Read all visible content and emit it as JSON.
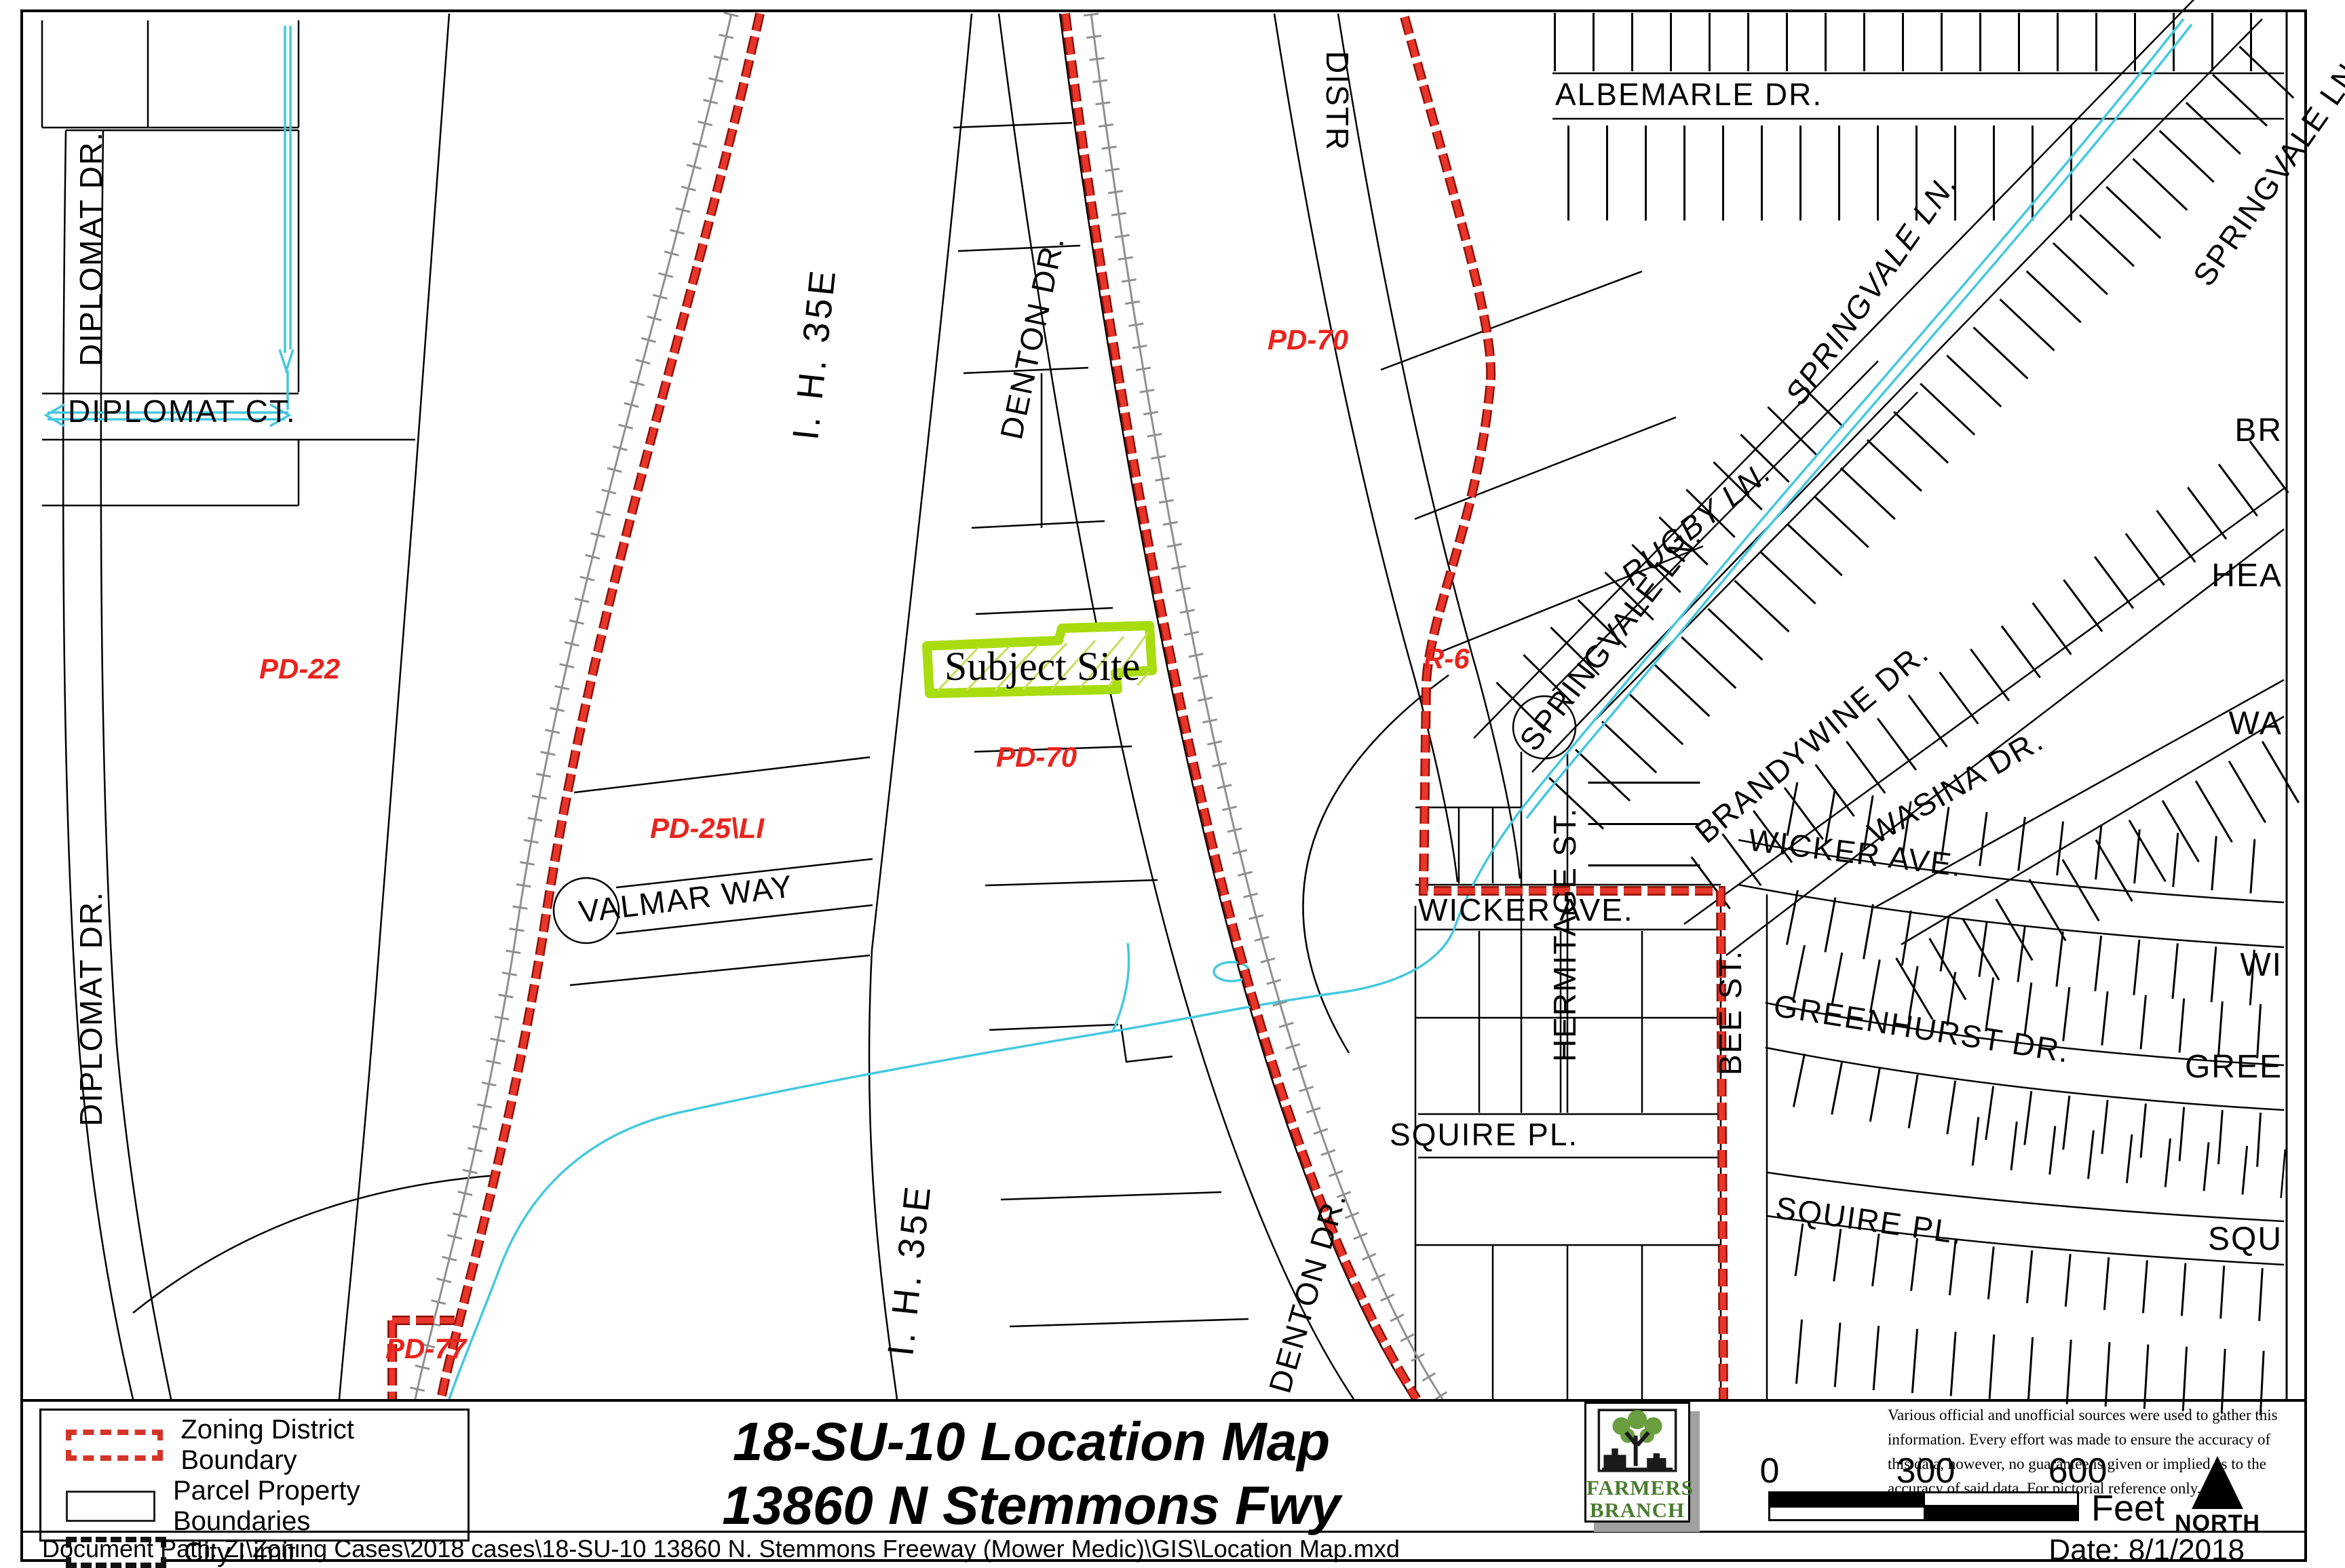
{
  "map": {
    "street_labels": {
      "diplomat_dr_top": "DIPLOMAT DR.",
      "diplomat_dr_bottom": "DIPLOMAT DR.",
      "diplomat_ct": "DIPLOMAT CT.",
      "ih35e_top": "I. H. 35E",
      "ih35e_bottom": "I. H. 35E",
      "denton_dr": "DENTON DR.",
      "denton_dr_lower": "DENTON DR.",
      "distr": "DISTR",
      "valmar_way": "VALMAR WAY",
      "albemarle_dr": "ALBEMARLE DR.",
      "rugby_ln": "RUGBY LN.",
      "springvale_ln_upper": "SPRINGVALE LN.",
      "springvale_ln_lower": "SPRINGVALE LN.",
      "springvale_ln_corner": "SPRINGVALE LN.",
      "brandywine_dr": "BRANDYWINE DR.",
      "wasina_dr": "WASINA DR.",
      "wicker_ave_right": "WICKER AVE.",
      "wicker_ave_left": "WICKER AVE.",
      "hermitage_st": "HERMITAGE ST.",
      "greenhurst_dr": "GREENHURST DR.",
      "bee_st": "BEE ST.",
      "squire_pl_left": "SQUIRE PL.",
      "squire_pl_right": "SQUIRE PL."
    },
    "edge_labels": {
      "br": "BR",
      "hea": "HEA",
      "wa": "WA",
      "wi": "WI",
      "gree": "GREE",
      "squ": "SQU"
    },
    "zoning_labels": {
      "pd22": "PD-22",
      "pd70_top": "PD-70",
      "pd70_mid": "PD-70",
      "pd25li": "PD-25\\LI",
      "r6": "R-6",
      "pd77": "PD-77"
    },
    "subject_site_label": "Subject Site",
    "colors": {
      "zoning_boundary_red": "#d43427",
      "subject_site_green": "#a8dc0e",
      "creek_cyan": "#45c8e0",
      "railroad_gray": "#909090"
    }
  },
  "legend": {
    "items": [
      {
        "label": "Zoning District Boundary",
        "swatch": "red-dashed-rectangle"
      },
      {
        "label": "Parcel Property Boundaries",
        "swatch": "plain-rectangle"
      },
      {
        "label": "City Limit",
        "swatch": "black-dashed-rectangle"
      }
    ]
  },
  "title": {
    "line1": "18-SU-10 Location Map",
    "line2": "13860 N Stemmons Fwy"
  },
  "logo": {
    "name_line1": "FARMERS",
    "name_line2": "BRANCH"
  },
  "notes": {
    "disclaimer": "Various official and unofficial sources were used to gather this information. Every effort was made to ensure the accuracy of this data, however, no guarantee is given or implied as to the accuracy of said data.  For pictorial reference only."
  },
  "scalebar": {
    "tick0": "0",
    "tick300": "300",
    "tick600": "600",
    "unit": "Feet"
  },
  "north_label": "NORTH",
  "date_text": "Date: 8/1/2018",
  "document_path": "Document Path: Z:\\Zoning Cases\\2018 cases\\18-SU-10 13860 N. Stemmons Freeway (Mower Medic)\\GIS\\Location Map.mxd"
}
